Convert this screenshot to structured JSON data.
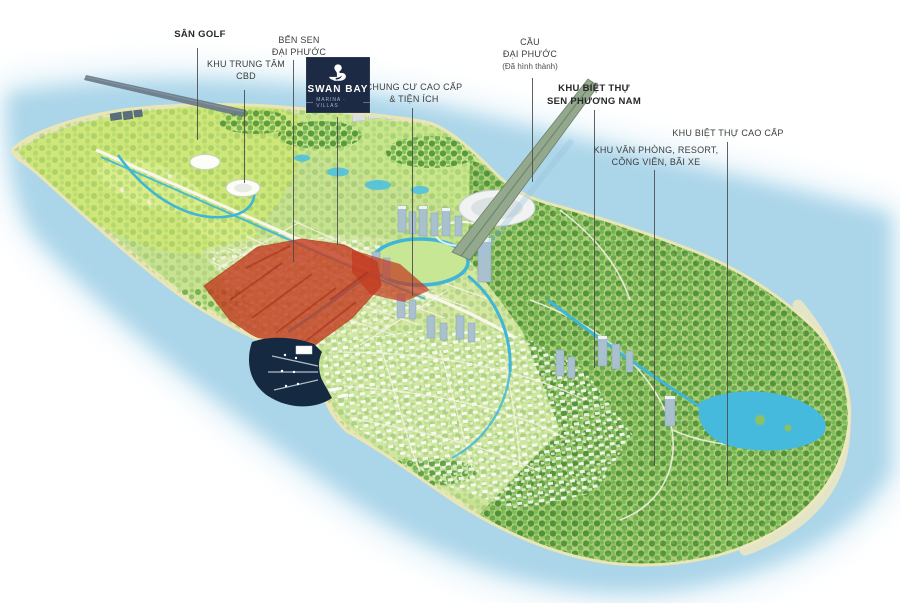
{
  "logo": {
    "brand": "SWAN BAY",
    "tagline": "MARINA · VILLAS",
    "icon": "swan-icon",
    "background_color": "#1d2a44"
  },
  "labels": {
    "san_golf": {
      "line1": "SÂN GOLF"
    },
    "khu_trung_tam_cbd": {
      "line1": "KHU TRUNG TÂM",
      "line2": "CBD"
    },
    "ben_sen_dai_phuoc": {
      "line1": "BẾN SEN",
      "line2": "ĐẠI PHƯỚC"
    },
    "chung_cu_cao_cap": {
      "line1": "CHUNG CƯ CAO CẤP",
      "line2": "& TIỆN ÍCH"
    },
    "cau_dai_phuoc": {
      "line1": "CẦU",
      "line2": "ĐẠI PHƯỚC",
      "line3": "(Đã hình thành)"
    },
    "sen_phuong_nam": {
      "line1": "KHU BIỆT THỰ",
      "line2": "SEN PHƯƠNG NAM"
    },
    "khu_van_phong": {
      "line1": "KHU VĂN PHÒNG, RESORT,",
      "line2": "CÔNG VIÊN, BÃI XE"
    },
    "biet_thu_cao_cap": {
      "line1": "KHU BIỆT THỰ CAO CẤP"
    }
  },
  "map_colors": {
    "water": "#abd5e9",
    "water_halo": "#dceff8",
    "island_green": "#c8e292",
    "golf_green": "#cfe779",
    "forest_green": "#4e9138",
    "canal_blue": "#3fb5d7",
    "sand_rim": "#e8e6b4",
    "highlight_zone_red": "#c43a20",
    "marina_navy": "#152a40",
    "leader_line": "#4b4b4b"
  }
}
